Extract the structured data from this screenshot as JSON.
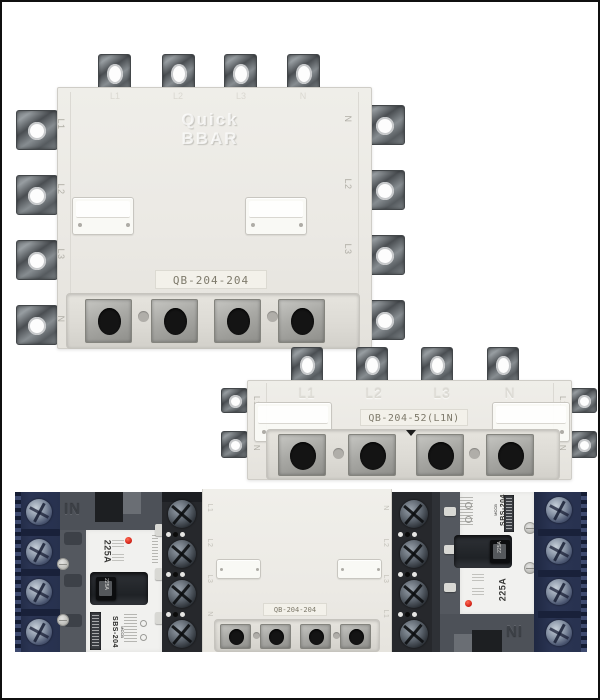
{
  "colors": {
    "background": "#ffffff",
    "frame": "#101010",
    "busbar_body": "#ebe9e4",
    "metal_lug": "#7e8488",
    "navy_terminal": "#27314e",
    "black_terminal": "#26282c",
    "breaker_face": "#f1f1ef",
    "red_indicator": "#d7281c"
  },
  "busbar_large": {
    "model": "QB-204-204",
    "embossed_line1": "Quick",
    "embossed_line2": "BBAR",
    "top_labels": [
      "L1",
      "L2",
      "L3",
      "N"
    ],
    "left_labels": [
      "L1",
      "L2",
      "L3",
      "N"
    ],
    "right_labels": [
      "N",
      "L2",
      "L3",
      "L1"
    ]
  },
  "busbar_strip": {
    "model": "QB-204-52(L1N)",
    "face_labels": [
      "L1",
      "L2",
      "L3",
      "N"
    ],
    "left_labels": [
      "L1",
      "N"
    ],
    "right_labels": [
      "L1",
      "N"
    ]
  },
  "breaker": {
    "brand_type": "MCCB",
    "model": "SBS-204",
    "rating": "225A",
    "handle_tag": "225A",
    "molded_mark": "IN"
  },
  "busbar_small": {
    "model": "QB-204-204",
    "left_labels": [
      "L1",
      "L2",
      "L3",
      "N"
    ],
    "right_labels": [
      "N",
      "L2",
      "L3",
      "L1"
    ]
  }
}
